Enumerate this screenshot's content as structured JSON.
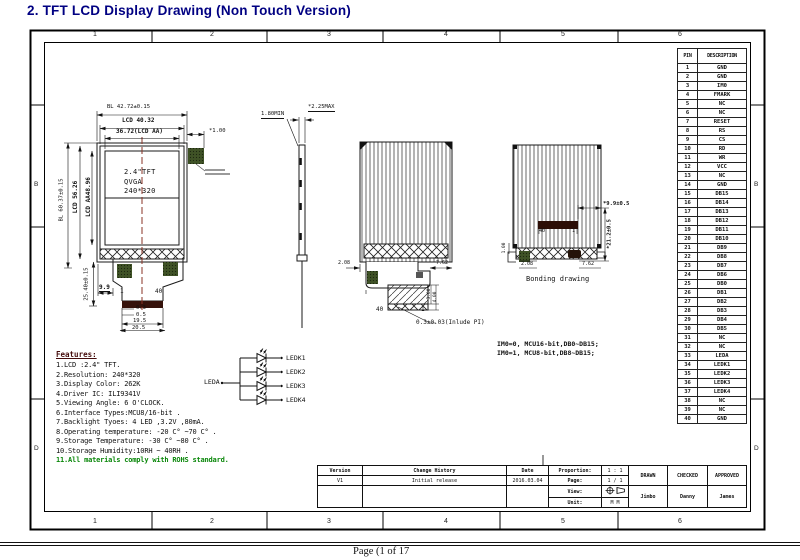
{
  "page": {
    "title": "2. TFT LCD Display Drawing (Non Touch Version)",
    "footer": "Page (1 of 17"
  },
  "frame": {
    "top_zones": [
      "1",
      "2",
      "3",
      "4",
      "5",
      "6"
    ],
    "bottom_zones": [
      "1",
      "2",
      "3",
      "4",
      "5",
      "6"
    ],
    "side_zones": [
      "B",
      "D"
    ]
  },
  "pin_table": {
    "headers": [
      "PIN",
      "DESCRIPTION"
    ],
    "rows": [
      [
        "1",
        "GND"
      ],
      [
        "2",
        "GND"
      ],
      [
        "3",
        "IM0"
      ],
      [
        "4",
        "FMARK"
      ],
      [
        "5",
        "NC"
      ],
      [
        "6",
        "NC"
      ],
      [
        "7",
        "RESET"
      ],
      [
        "8",
        "RS"
      ],
      [
        "9",
        "CS"
      ],
      [
        "10",
        "RD"
      ],
      [
        "11",
        "WR"
      ],
      [
        "12",
        "VCC"
      ],
      [
        "13",
        "NC"
      ],
      [
        "14",
        "GND"
      ],
      [
        "15",
        "DB15"
      ],
      [
        "16",
        "DB14"
      ],
      [
        "17",
        "DB13"
      ],
      [
        "18",
        "DB12"
      ],
      [
        "19",
        "DB11"
      ],
      [
        "20",
        "DB10"
      ],
      [
        "21",
        "DB9"
      ],
      [
        "22",
        "DB8"
      ],
      [
        "23",
        "DB7"
      ],
      [
        "24",
        "DB6"
      ],
      [
        "25",
        "DB0"
      ],
      [
        "26",
        "DB1"
      ],
      [
        "27",
        "DB2"
      ],
      [
        "28",
        "DB3"
      ],
      [
        "29",
        "DB4"
      ],
      [
        "30",
        "DB5"
      ],
      [
        "31",
        "NC"
      ],
      [
        "32",
        "NC"
      ],
      [
        "33",
        "LEDA"
      ],
      [
        "34",
        "LEDK1"
      ],
      [
        "35",
        "LEDK2"
      ],
      [
        "36",
        "LEDK3"
      ],
      [
        "37",
        "LEDK4"
      ],
      [
        "38",
        "NC"
      ],
      [
        "39",
        "NC"
      ],
      [
        "40",
        "GND"
      ]
    ]
  },
  "front_view": {
    "dim_bl_w": "BL 42.72±0.15",
    "dim_lcd_w": "LCD 40.32",
    "dim_aa_w": "36.72(LCD AA)",
    "dim_fmark": "*1.00",
    "dim_bl_h": "BL 60.37±0.15",
    "dim_lcd_h": "LCD 56.26",
    "dim_aa_h": "LCD AA48.96",
    "dim_fpc_len": "25.40±0.15",
    "dim_fpc_off": "9.9",
    "pin_first": "1",
    "pin_last": "40",
    "dim_03": "0.3",
    "dim_05": "0.5",
    "dim_195": "19.5",
    "dim_205": "20.5",
    "panel_lines": [
      "2.4\"TFT",
      "QVGA",
      "240*320"
    ]
  },
  "side_view": {
    "dim_thick": "*2.25MAX",
    "dim_min": "1.80MIN"
  },
  "back_view": {
    "dim_left": "2.08",
    "dim_right": "7.62",
    "dim_s1": "3.00",
    "dim_s2": "4.00",
    "pin_last": "40",
    "pin_first": "1",
    "note": "0.3±0.03(Inlude PI)"
  },
  "bonding_view": {
    "caption": "Bonding drawing",
    "dim_w": "*9.9±0.5",
    "dim_h": "*21.2±0.5",
    "dim_left": "2.08",
    "dim_right": "7.62",
    "dim_edge": "1.00",
    "pin_last": "40",
    "pin_first": "1"
  },
  "im_note": {
    "line1": "IM0=0, MCU16-bit,DB0~DB15;",
    "line2": "IM0=1, MCU8-bit,DB8~DB15;"
  },
  "led_circuit": {
    "input": "LEDA",
    "outputs": [
      "LEDK1",
      "LEDK2",
      "LEDK3",
      "LEDK4"
    ]
  },
  "features": {
    "heading": "Features:",
    "items": [
      "1.LCD :2.4\" TFT.",
      "2.Resolution: 240*320",
      "3.Display Color: 262K",
      "4.Driver IC: ILI9341V",
      "5.Viewing Angle: 6 O'CLOCK.",
      "6.Interface Types:MCU8/16-bit .",
      "7.Backlight Tyoes: 4 LED ,3.2V ,80mA.",
      "8.Operating temperature: -20 C° ~70 C° .",
      "9.Storage Temperature: -30 C° ~80 C° .",
      "10.Storage Humidity:10RH ~ 40RH ."
    ],
    "rohs": "11.All materials comply with ROHS standard."
  },
  "title_block": {
    "version_label": "Version",
    "version_value": "V1",
    "change_label": "Change History",
    "change_value": "Initial release",
    "date_label": "Date",
    "date_value": "2016.03.04",
    "proportion_label": "Proportion:",
    "proportion_value": "1 : 1",
    "page_label": "Page:",
    "page_value": "1 / 1",
    "view_label": "View:",
    "unit_label": "Unit:",
    "unit_value": "M M",
    "drawn_label": "DRAWN",
    "checked_label": "CHECKED",
    "approved_label": "APPROVED",
    "drawn_name": "Jimbo",
    "checked_name": "Danny",
    "approved_name": "James"
  }
}
